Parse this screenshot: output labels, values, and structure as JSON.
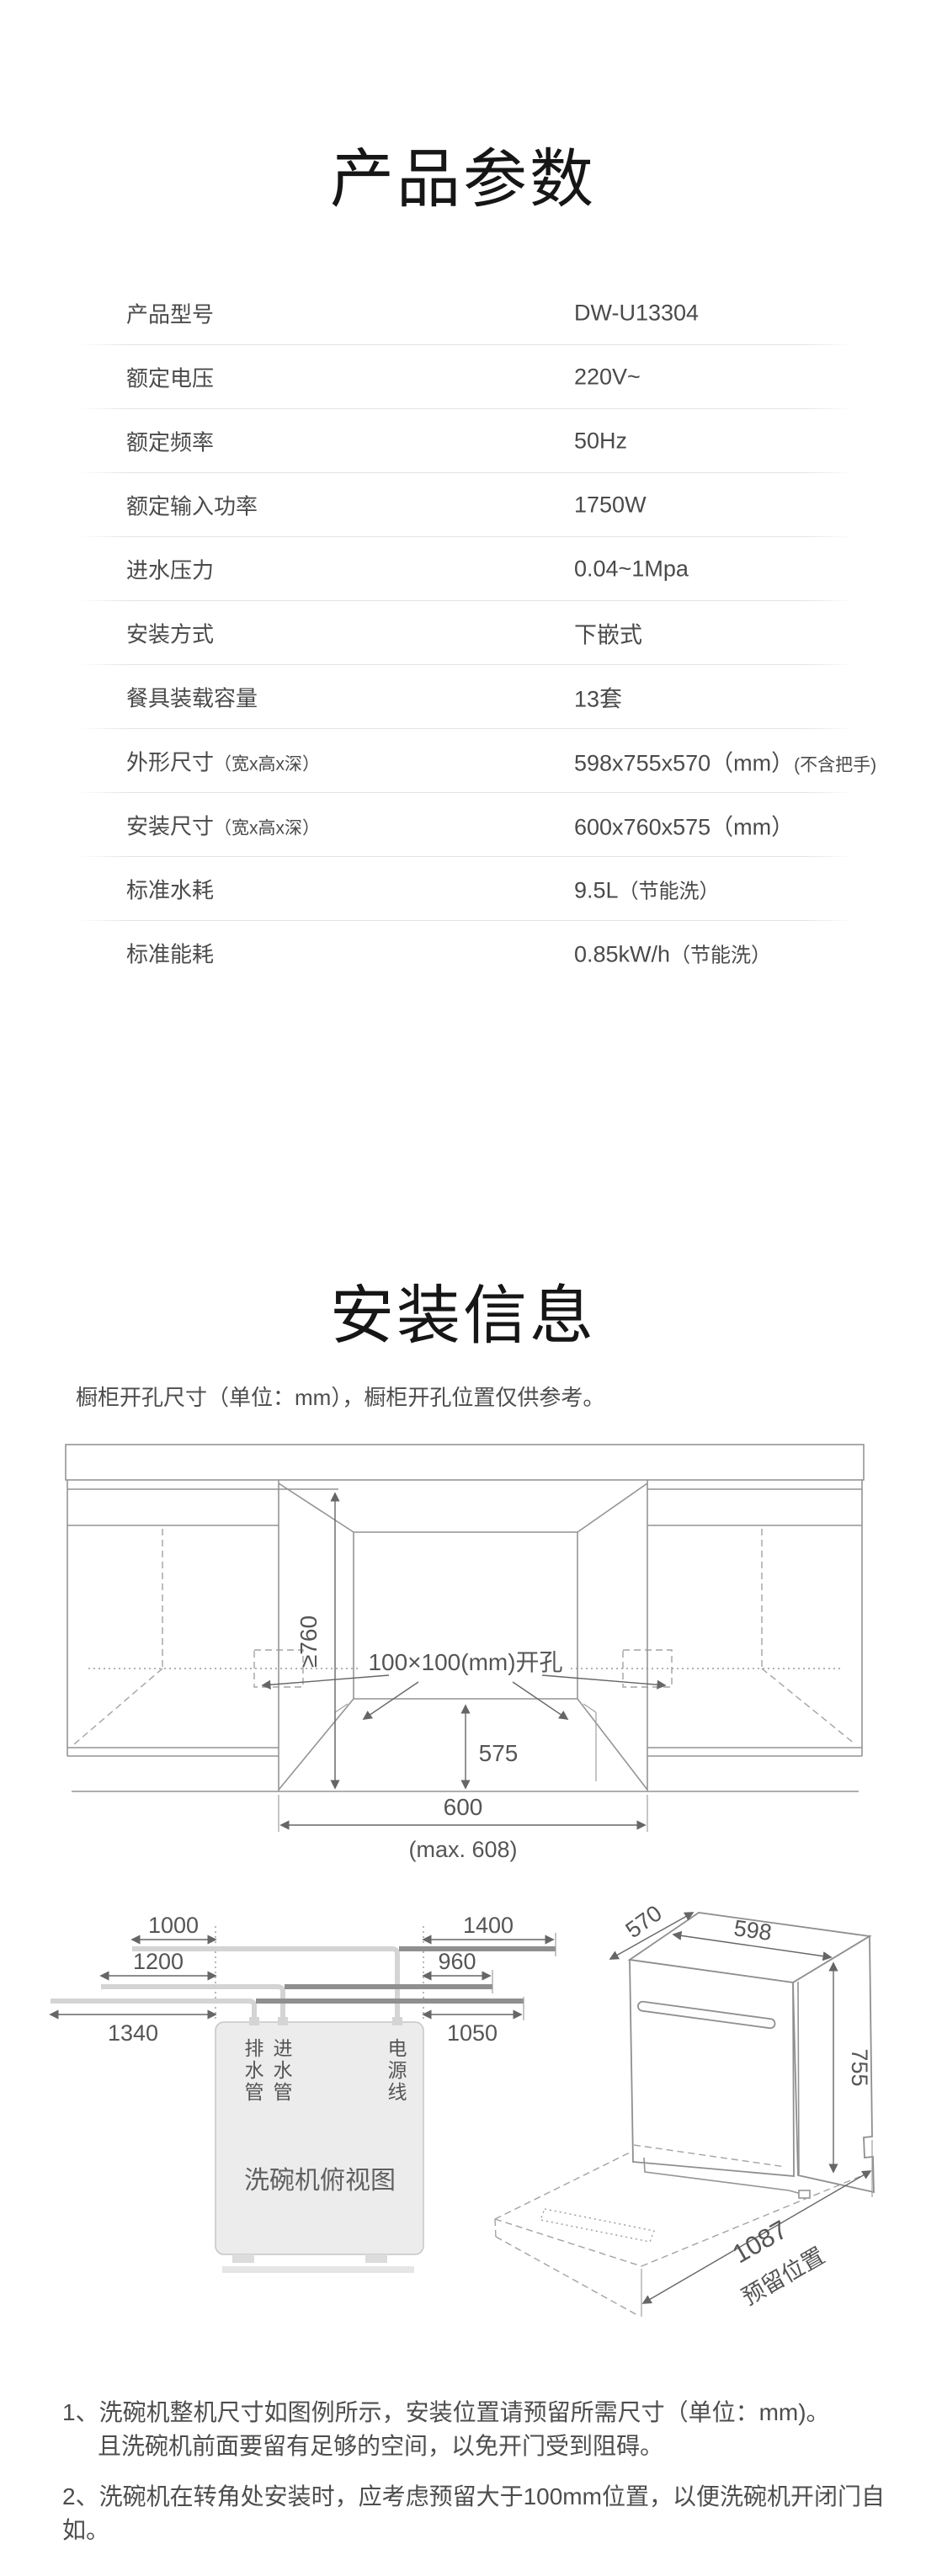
{
  "sections": {
    "params_title": "产品参数",
    "install_title": "安装信息",
    "install_note": "橱柜开孔尺寸（单位：mm），橱柜开孔位置仅供参考。"
  },
  "spec_table": {
    "rows": [
      {
        "label": "产品型号",
        "value": "DW-U13304"
      },
      {
        "label": "额定电压",
        "value": "220V~"
      },
      {
        "label": "额定频率",
        "value": "50Hz"
      },
      {
        "label": "额定输入功率",
        "value": "1750W"
      },
      {
        "label": "进水压力",
        "value": "0.04~1Mpa"
      },
      {
        "label": "安装方式",
        "value": "下嵌式"
      },
      {
        "label": "餐具装载容量",
        "value": "13套"
      },
      {
        "label": "外形尺寸",
        "label_note": "（宽x高x深）",
        "value": "598x755x570（mm）",
        "value_note": "(不含把手)"
      },
      {
        "label": "安装尺寸",
        "label_note": "（宽x高x深）",
        "value": "600x760x575（mm）"
      },
      {
        "label": "标准水耗",
        "value": "9.5L",
        "value_note": "（节能洗）"
      },
      {
        "label": "标准能耗",
        "value": "0.85kW/h",
        "value_note": "（节能洗）"
      }
    ]
  },
  "diag1": {
    "height_min": "≥760",
    "cutout_label": "100×100(mm)开孔",
    "depth": "575",
    "width": "600",
    "width_max": "(max. 608)"
  },
  "diag2": {
    "dim_1000": "1000",
    "dim_1200": "1200",
    "dim_1340": "1340",
    "dim_1400": "1400",
    "dim_960": "960",
    "dim_1050": "1050",
    "top_view_label": "洗碗机俯视图",
    "pipe_labels": {
      "drain": [
        "排",
        "水",
        "管"
      ],
      "inlet": [
        "进",
        "水",
        "管"
      ],
      "power": [
        "电",
        "源",
        "线"
      ]
    }
  },
  "diag3": {
    "depth": "570",
    "width": "598",
    "height": "755",
    "reserve": "1087",
    "reserve_label": "预留位置"
  },
  "notes": {
    "line1": "1、洗碗机整机尺寸如图例所示，安装位置请预留所需尺寸（单位：mm)。",
    "line2": "且洗碗机前面要留有足够的空间，以免开门受到阻碍。",
    "line3": "2、洗碗机在转角处安装时，应考虑预留大于100mm位置，以便洗碗机开闭门自如。"
  }
}
